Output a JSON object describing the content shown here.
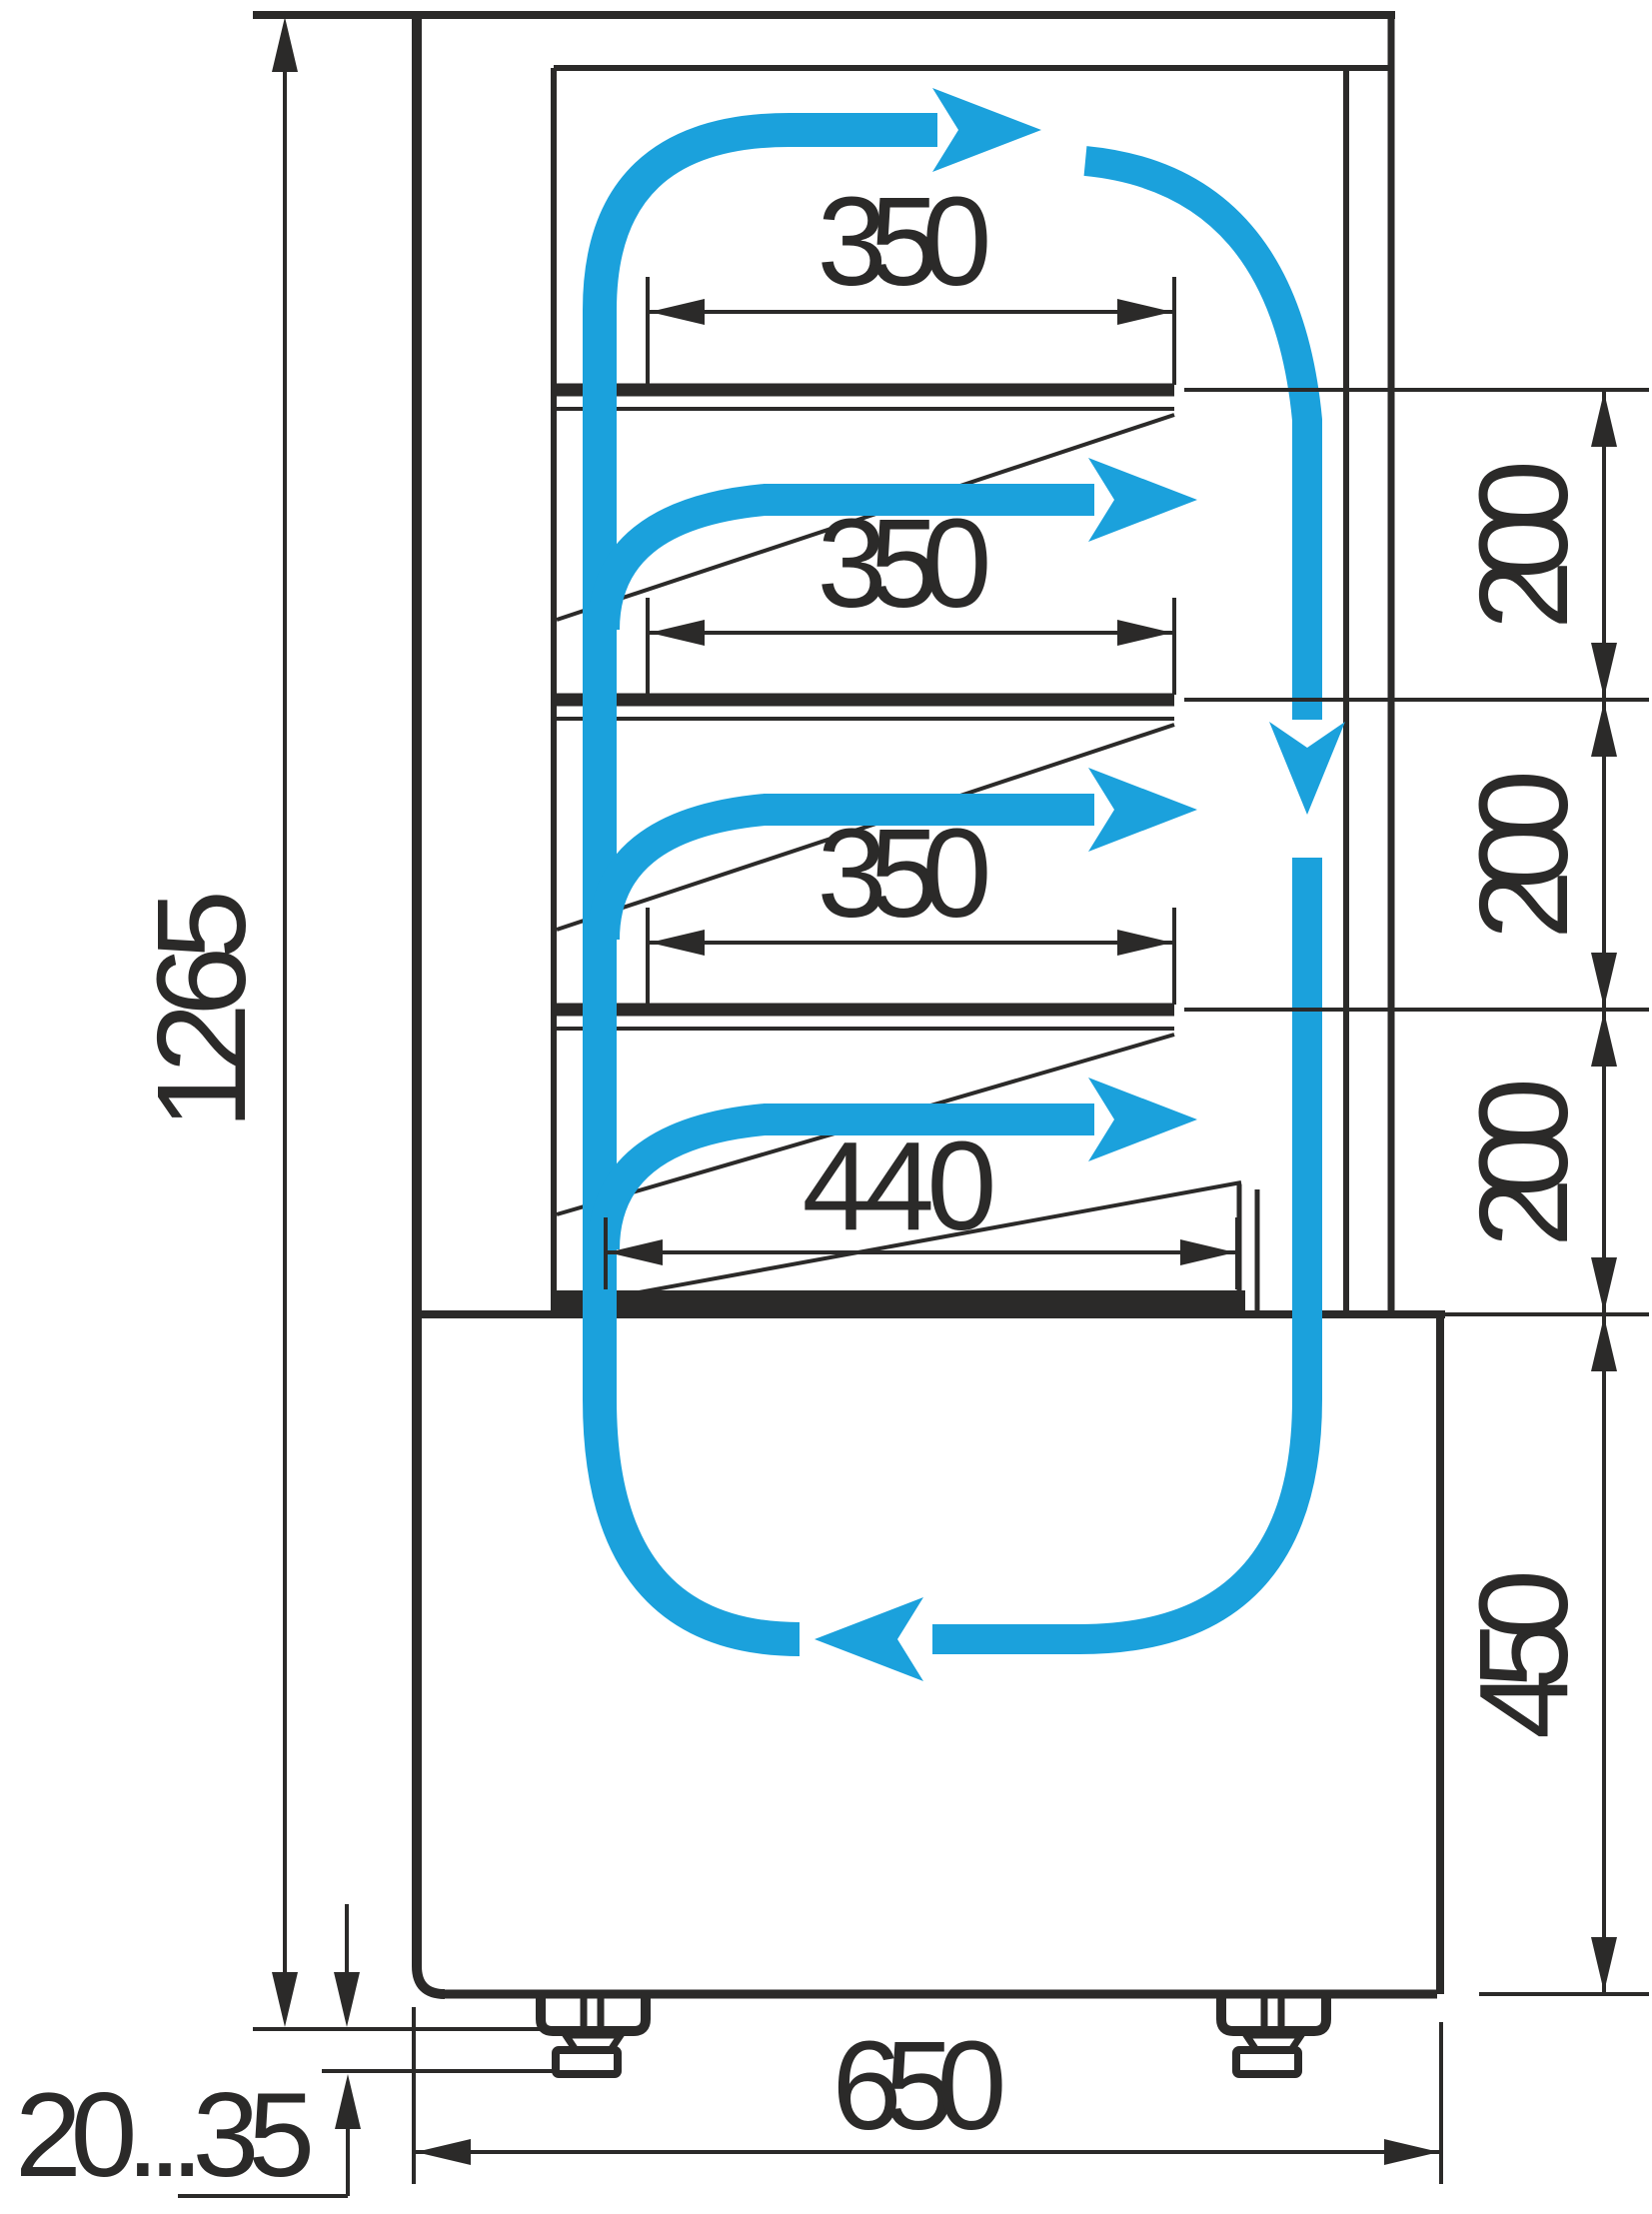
{
  "drawing": {
    "kind": "refrigerated-display-case-side-section",
    "dims": {
      "total_height": "1265",
      "shelf_depths": [
        "350",
        "350",
        "350"
      ],
      "bottom_shelf_depth": "440",
      "shelf_gaps": [
        "200",
        "200",
        "200"
      ],
      "base_height": "450",
      "overall_depth": "650",
      "leg_adjust_range": "20...35"
    },
    "colors": {
      "line": "#2b2a29",
      "airflow": "#1ba1dc",
      "background": "#ffffff"
    }
  }
}
